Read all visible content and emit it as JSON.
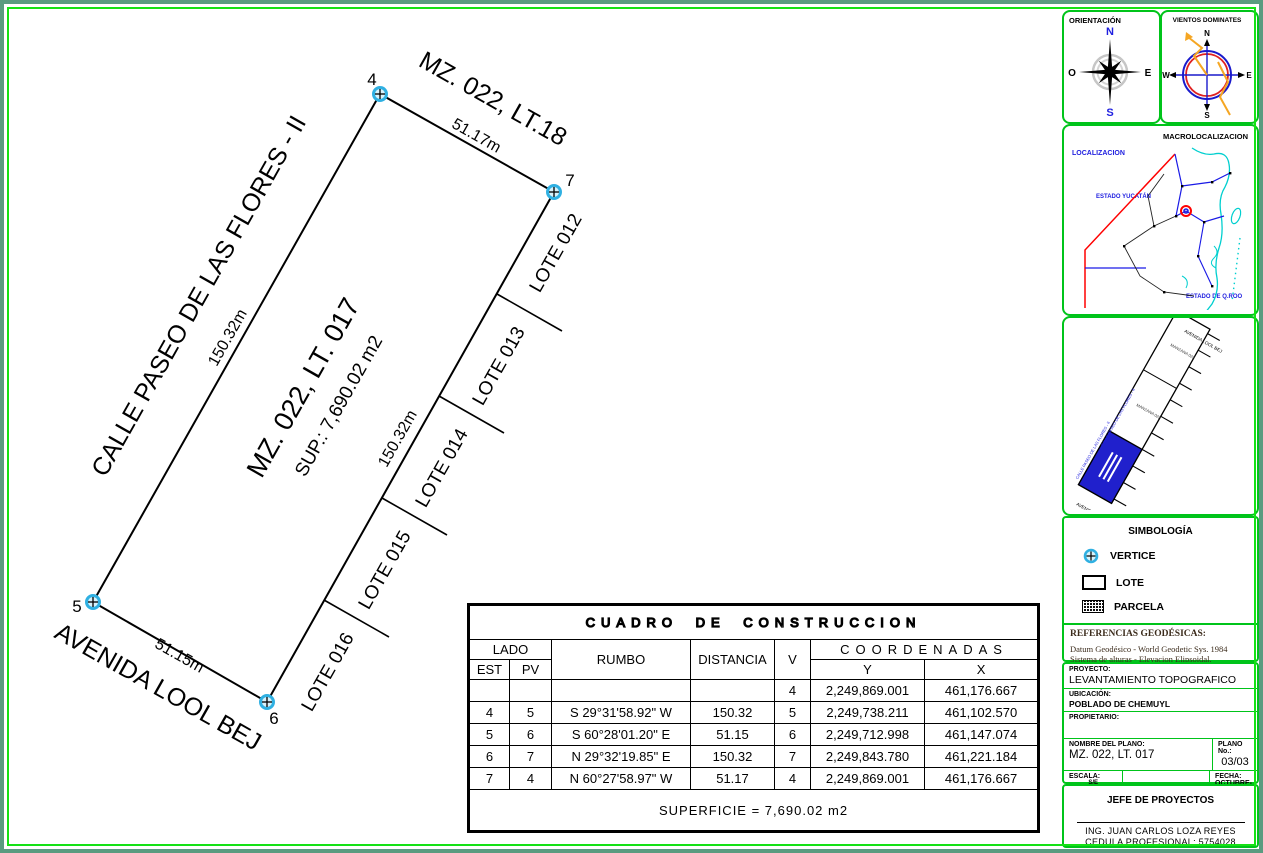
{
  "drawing": {
    "neighbor_label": "MZ. 022, LT.18",
    "street_west": "CALLE PASEO DE LAS FLORES - II",
    "street_south": "AVENIDA LOOL BEJ",
    "parcel_title": "MZ. 022, LT. 017",
    "parcel_area": "SUP.: 7,690.02 m2",
    "dim_north": "51.17m",
    "dim_west": "150.32m",
    "dim_east": "150.32m",
    "dim_south": "51.15m",
    "lots": [
      "LOTE 012",
      "LOTE 013",
      "LOTE 014",
      "LOTE 015",
      "LOTE 016"
    ],
    "vertices": [
      "4",
      "7",
      "5",
      "6"
    ]
  },
  "table": {
    "title": "CUADRO DE CONSTRUCCION",
    "h": {
      "lado": "LADO",
      "est": "EST",
      "pv": "PV",
      "rumbo": "RUMBO",
      "distancia": "DISTANCIA",
      "v": "V",
      "coordenadas": "COORDENADAS",
      "y": "Y",
      "x": "X"
    },
    "rows": [
      {
        "est": "",
        "pv": "",
        "rumbo": "",
        "dist": "",
        "v": "4",
        "y": "2,249,869.001",
        "x": "461,176.667"
      },
      {
        "est": "4",
        "pv": "5",
        "rumbo": "S 29°31'58.92\" W",
        "dist": "150.32",
        "v": "5",
        "y": "2,249,738.211",
        "x": "461,102.570"
      },
      {
        "est": "5",
        "pv": "6",
        "rumbo": "S 60°28'01.20\" E",
        "dist": "51.15",
        "v": "6",
        "y": "2,249,712.998",
        "x": "461,147.074"
      },
      {
        "est": "6",
        "pv": "7",
        "rumbo": "N 29°32'19.85\" E",
        "dist": "150.32",
        "v": "7",
        "y": "2,249,843.780",
        "x": "461,221.184"
      },
      {
        "est": "7",
        "pv": "4",
        "rumbo": "N 60°27'58.97\" W",
        "dist": "51.17",
        "v": "4",
        "y": "2,249,869.001",
        "x": "461,176.667"
      }
    ],
    "superficie": "SUPERFICIE = 7,690.02 m2"
  },
  "sidebar": {
    "orientation": {
      "title": "ORIENTACIÓN",
      "n": "N",
      "s": "S",
      "e": "E",
      "o": "O"
    },
    "winds": {
      "title": "VIENTOS DOMINATES",
      "n": "N",
      "s": "S",
      "e": "E",
      "w": "W"
    },
    "macro": {
      "title": "MACROLOCALIZACION",
      "localizacion": "LOCALIZACION",
      "yucatan": "ESTADO YUCATÁN",
      "qroo": "ESTADO DE Q.ROO"
    },
    "micro": {
      "street_top": "AVENIDA LOOL BEJ",
      "street_bottom": "AVENIDA LOOL BEJ",
      "side_street": "CALLE PASEO DE LAS FLORES - II",
      "block": "MANZANA 022"
    },
    "simbologia": {
      "title": "SIMBOLOGÍA",
      "vertice": "VERTICE",
      "lote": "LOTE",
      "parcela": "PARCELA"
    },
    "referencias": {
      "title": "REFERENCIAS GEODÉSICAS:",
      "l1": "Datum Geodésico - World Geodetic Sys. 1984",
      "l2": "Sistema de alturas - Elevacion Elipsoidal.",
      "l3": "Proy. cartográfica - Universal Transverse Merc.",
      "l4": "Zona _16N (84°W - 90°W)"
    },
    "titleblock": {
      "proyecto_label": "PROYECTO:",
      "proyecto": "LEVANTAMIENTO TOPOGRAFICO",
      "ubicacion_label": "UBICACIÓN:",
      "ubicacion": "POBLADO DE CHEMUYL",
      "propietario_label": "PROPIETARIO:",
      "nombre_label": "NOMBRE DEL PLANO:",
      "nombre": "MZ. 022, LT. 017",
      "plano_label": "PLANO No.:",
      "plano": "03/03",
      "escala_label": "ESCALA:",
      "escala": "S/E",
      "fecha_label": "FECHA:",
      "fecha": "OCTUBRE-2023"
    },
    "firma": {
      "title": "JEFE DE PROYECTOS",
      "nombre": "ING. JUAN CARLOS LOZA REYES",
      "cedula": "CEDULA PROFESIONAL: 5754028"
    }
  },
  "colors": {
    "panel_green": "#00c41a",
    "frame_green": "#5a9b80",
    "bright_green": "#15e215",
    "vertex_cyan": "#2fb0e2",
    "lot_blue": "#2020cc",
    "map_cyan": "#00cfcf",
    "map_red": "#ff0000",
    "wind_orange": "#f5a623"
  }
}
